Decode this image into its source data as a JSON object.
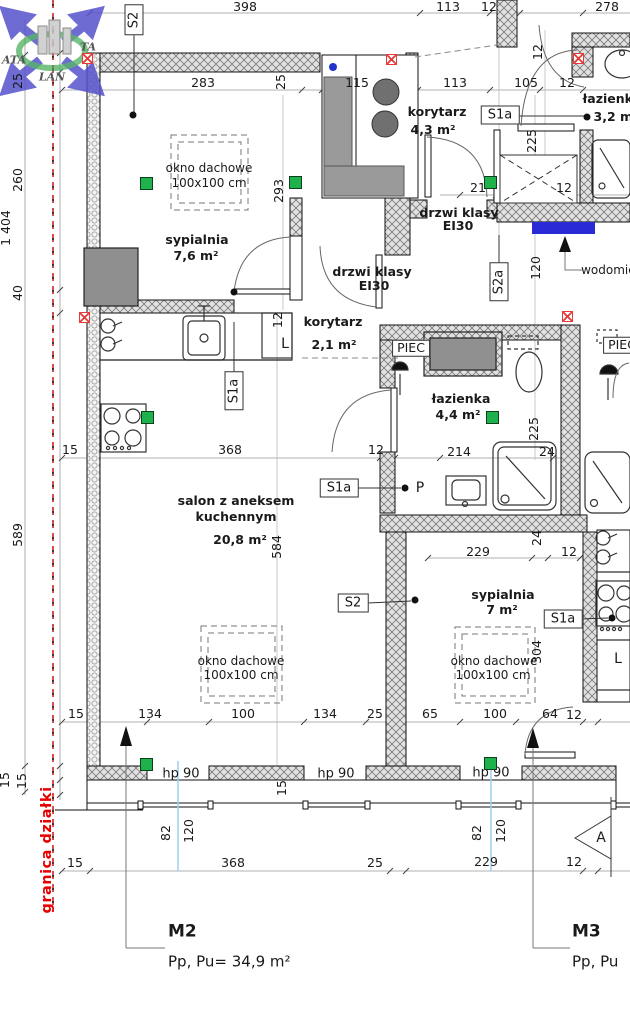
{
  "document": {
    "type": "architectural floor plan",
    "apartments": [
      {
        "name": "M2",
        "area_label": "Pp, Pu= 34,9 m²"
      },
      {
        "name": "M3",
        "area_label": "Pp, Pu"
      }
    ],
    "boundary_label": "granica działki",
    "section_marker": "A",
    "watermark": [
      "ATA",
      "TA",
      "LAN"
    ]
  },
  "colors": {
    "vent_green": "#1fb14b",
    "marker_red": "#e63b3b",
    "meter_blue": "#2a2ad6",
    "boundary_red": "#e60000",
    "window_axis_cyan": "#9ad1ee",
    "wall_gray": "#e2e2e2"
  },
  "rooms": [
    {
      "name": "sypialnia",
      "area": "7,6 m²"
    },
    {
      "name": "korytarz",
      "area": "4,3 m²"
    },
    {
      "name": "łazienka",
      "area": "3,2 m²"
    },
    {
      "name": "korytarz",
      "area": "2,1 m²"
    },
    {
      "name": "łazienka",
      "area": "4,4 m²"
    },
    {
      "name": "salon z aneksem kuchennym",
      "area": "20,8 m²"
    },
    {
      "name": "sypialnia",
      "area": "7 m²"
    }
  ],
  "labels": [
    {
      "t": "398",
      "x": 245,
      "y": 7,
      "c": "dim",
      "n": "dim-label"
    },
    {
      "t": "113",
      "x": 448,
      "y": 7,
      "c": "dim",
      "n": "dim-label"
    },
    {
      "t": "12",
      "x": 489,
      "y": 7,
      "c": "dim",
      "n": "dim-label"
    },
    {
      "t": "278",
      "x": 607,
      "y": 7,
      "c": "dim",
      "n": "dim-label"
    },
    {
      "t": "283",
      "x": 203,
      "y": 83,
      "c": "dim",
      "n": "dim-label"
    },
    {
      "t": "25",
      "x": 281,
      "y": 82,
      "c": "dim",
      "r": 1,
      "n": "dim-label"
    },
    {
      "t": "115",
      "x": 357,
      "y": 83,
      "c": "dim",
      "n": "dim-label"
    },
    {
      "t": "113",
      "x": 455,
      "y": 83,
      "c": "dim",
      "n": "dim-label"
    },
    {
      "t": "105",
      "x": 526,
      "y": 83,
      "c": "dim",
      "n": "dim-label"
    },
    {
      "t": "12",
      "x": 567,
      "y": 83,
      "c": "dim",
      "n": "dim-label"
    },
    {
      "t": "12",
      "x": 538,
      "y": 52,
      "c": "dim",
      "r": 1,
      "n": "dim-label"
    },
    {
      "t": "1 404",
      "x": 6,
      "y": 228,
      "c": "dim",
      "r": 1,
      "n": "dim-label"
    },
    {
      "t": "25",
      "x": 18,
      "y": 81,
      "c": "dim",
      "r": 1,
      "n": "dim-label"
    },
    {
      "t": "260",
      "x": 18,
      "y": 180,
      "c": "dim",
      "r": 1,
      "n": "dim-label"
    },
    {
      "t": "40",
      "x": 18,
      "y": 293,
      "c": "dim",
      "r": 1,
      "n": "dim-label"
    },
    {
      "t": "589",
      "x": 18,
      "y": 535,
      "c": "dim",
      "r": 1,
      "n": "dim-label"
    },
    {
      "t": "15",
      "x": 5,
      "y": 780,
      "c": "dim",
      "r": 1,
      "n": "dim-label"
    },
    {
      "t": "15",
      "x": 22,
      "y": 781,
      "c": "dim",
      "r": 1,
      "n": "dim-label"
    },
    {
      "t": "293",
      "x": 279,
      "y": 191,
      "c": "dim",
      "r": 1,
      "n": "dim-label"
    },
    {
      "t": "12",
      "x": 278,
      "y": 320,
      "c": "dim",
      "r": 1,
      "n": "dim-label"
    },
    {
      "t": "584",
      "x": 277,
      "y": 547,
      "c": "dim",
      "r": 1,
      "n": "dim-label"
    },
    {
      "t": "21",
      "x": 478,
      "y": 188,
      "c": "dim",
      "n": "dim-label"
    },
    {
      "t": "12",
      "x": 564,
      "y": 188,
      "c": "dim",
      "n": "dim-label"
    },
    {
      "t": "225",
      "x": 532,
      "y": 141,
      "c": "dim",
      "r": 1,
      "n": "dim-label"
    },
    {
      "t": "120",
      "x": 536,
      "y": 268,
      "c": "dim",
      "r": 1,
      "n": "dim-label"
    },
    {
      "t": "225",
      "x": 534,
      "y": 429,
      "c": "dim",
      "r": 1,
      "n": "dim-label"
    },
    {
      "t": "15",
      "x": 70,
      "y": 450,
      "c": "dim",
      "n": "dim-label"
    },
    {
      "t": "368",
      "x": 230,
      "y": 450,
      "c": "dim",
      "n": "dim-label"
    },
    {
      "t": "12",
      "x": 376,
      "y": 450,
      "c": "dim",
      "n": "dim-label"
    },
    {
      "t": "214",
      "x": 459,
      "y": 452,
      "c": "dim",
      "n": "dim-label"
    },
    {
      "t": "24",
      "x": 547,
      "y": 452,
      "c": "dim",
      "n": "dim-label"
    },
    {
      "t": "24",
      "x": 537,
      "y": 538,
      "c": "dim",
      "r": 1,
      "n": "dim-label"
    },
    {
      "t": "229",
      "x": 478,
      "y": 552,
      "c": "dim",
      "n": "dim-label"
    },
    {
      "t": "12",
      "x": 569,
      "y": 552,
      "c": "dim",
      "n": "dim-label"
    },
    {
      "t": "304",
      "x": 537,
      "y": 652,
      "c": "dim",
      "r": 1,
      "n": "dim-label"
    },
    {
      "t": "15",
      "x": 76,
      "y": 714,
      "c": "dim",
      "n": "dim-label"
    },
    {
      "t": "134",
      "x": 150,
      "y": 714,
      "c": "dim",
      "n": "dim-label"
    },
    {
      "t": "100",
      "x": 243,
      "y": 714,
      "c": "dim",
      "n": "dim-label"
    },
    {
      "t": "134",
      "x": 325,
      "y": 714,
      "c": "dim",
      "n": "dim-label"
    },
    {
      "t": "25",
      "x": 375,
      "y": 714,
      "c": "dim",
      "n": "dim-label"
    },
    {
      "t": "65",
      "x": 430,
      "y": 714,
      "c": "dim",
      "n": "dim-label"
    },
    {
      "t": "100",
      "x": 495,
      "y": 714,
      "c": "dim",
      "n": "dim-label"
    },
    {
      "t": "64",
      "x": 550,
      "y": 714,
      "c": "dim",
      "n": "dim-label"
    },
    {
      "t": "12",
      "x": 574,
      "y": 715,
      "c": "dim",
      "n": "dim-label"
    },
    {
      "t": "15",
      "x": 282,
      "y": 788,
      "c": "dim",
      "r": 1,
      "n": "dim-label"
    },
    {
      "t": "82",
      "x": 166,
      "y": 833,
      "c": "dim",
      "r": 1,
      "n": "dim-label"
    },
    {
      "t": "120",
      "x": 189,
      "y": 831,
      "c": "dim",
      "r": 1,
      "n": "dim-label"
    },
    {
      "t": "82",
      "x": 477,
      "y": 833,
      "c": "dim",
      "r": 1,
      "n": "dim-label"
    },
    {
      "t": "120",
      "x": 501,
      "y": 831,
      "c": "dim",
      "r": 1,
      "n": "dim-label"
    },
    {
      "t": "15",
      "x": 75,
      "y": 863,
      "c": "dim",
      "n": "dim-label"
    },
    {
      "t": "368",
      "x": 233,
      "y": 863,
      "c": "dim",
      "n": "dim-label"
    },
    {
      "t": "25",
      "x": 375,
      "y": 863,
      "c": "dim",
      "n": "dim-label"
    },
    {
      "t": "229",
      "x": 486,
      "y": 862,
      "c": "dim",
      "n": "dim-label"
    },
    {
      "t": "12",
      "x": 574,
      "y": 862,
      "c": "dim",
      "n": "dim-label"
    },
    {
      "t": "sypialnia",
      "x": 197,
      "y": 240,
      "c": "room",
      "n": "room-name-sypialnia-76"
    },
    {
      "t": "7,6 m²",
      "x": 196,
      "y": 256,
      "c": "room",
      "n": "room-area-sypialnia-76"
    },
    {
      "t": "korytarz",
      "x": 437,
      "y": 112,
      "c": "room",
      "n": "room-name-korytarz-43"
    },
    {
      "t": "4,3 m²",
      "x": 433,
      "y": 130,
      "c": "room",
      "n": "room-area-korytarz-43"
    },
    {
      "t": "łazienka",
      "x": 612,
      "y": 99,
      "c": "room",
      "n": "room-name-lazienka-32"
    },
    {
      "t": "3,2 m²",
      "x": 616,
      "y": 117,
      "c": "room",
      "n": "room-area-lazienka-32"
    },
    {
      "t": "drzwi klasy",
      "x": 459,
      "y": 213,
      "c": "room",
      "n": "door-class-label"
    },
    {
      "t": "EI30",
      "x": 458,
      "y": 226,
      "c": "room",
      "n": "door-class-label"
    },
    {
      "t": "drzwi klasy",
      "x": 372,
      "y": 272,
      "c": "room",
      "n": "door-class-label"
    },
    {
      "t": "EI30",
      "x": 374,
      "y": 286,
      "c": "room",
      "n": "door-class-label"
    },
    {
      "t": "korytarz",
      "x": 333,
      "y": 322,
      "c": "room",
      "n": "room-name-korytarz-21"
    },
    {
      "t": "2,1 m²",
      "x": 334,
      "y": 345,
      "c": "room",
      "n": "room-area-korytarz-21"
    },
    {
      "t": "łazienka",
      "x": 461,
      "y": 399,
      "c": "room",
      "n": "room-name-lazienka-44"
    },
    {
      "t": "4,4 m²",
      "x": 458,
      "y": 415,
      "c": "room",
      "n": "room-area-lazienka-44"
    },
    {
      "t": "salon z aneksem",
      "x": 236,
      "y": 501,
      "c": "room",
      "n": "room-name-salon"
    },
    {
      "t": "kuchennym",
      "x": 236,
      "y": 517,
      "c": "room",
      "n": "room-name-salon"
    },
    {
      "t": "20,8 m²",
      "x": 240,
      "y": 540,
      "c": "room",
      "n": "room-area-salon"
    },
    {
      "t": "sypialnia",
      "x": 503,
      "y": 595,
      "c": "room",
      "n": "room-name-sypialnia-7"
    },
    {
      "t": "7 m²",
      "x": 502,
      "y": 610,
      "c": "room",
      "n": "room-area-sypialnia-7"
    },
    {
      "t": "okno dachowe",
      "x": 209,
      "y": 168,
      "c": "sub",
      "n": "skylight-label"
    },
    {
      "t": "100x100 cm",
      "x": 209,
      "y": 183,
      "c": "sub",
      "n": "skylight-size"
    },
    {
      "t": "okno dachowe",
      "x": 241,
      "y": 661,
      "c": "sub",
      "n": "skylight-label"
    },
    {
      "t": "100x100 cm",
      "x": 241,
      "y": 675,
      "c": "sub",
      "n": "skylight-size"
    },
    {
      "t": "okno dachowe",
      "x": 494,
      "y": 661,
      "c": "sub",
      "n": "skylight-label"
    },
    {
      "t": "100x100 cm",
      "x": 493,
      "y": 675,
      "c": "sub",
      "n": "skylight-size"
    },
    {
      "t": "PIEC",
      "x": 411,
      "y": 348,
      "c": "pbox",
      "n": "furnace-label"
    },
    {
      "t": "PIEC",
      "x": 622,
      "y": 345,
      "c": "pbox",
      "n": "furnace-label"
    },
    {
      "t": "wodomierz",
      "x": 614,
      "y": 270,
      "c": "sub",
      "n": "water-meter-label"
    },
    {
      "t": "P",
      "x": 420,
      "y": 488,
      "c": "plabel",
      "n": "p-point-label"
    },
    {
      "t": "L",
      "x": 285,
      "y": 344,
      "c": "plabel",
      "n": "fridge-label"
    },
    {
      "t": "L",
      "x": 618,
      "y": 659,
      "c": "plabel",
      "n": "fridge-label"
    },
    {
      "t": "hp 90",
      "x": 181,
      "y": 774,
      "c": "hp",
      "n": "parapet-height-label"
    },
    {
      "t": "hp 90",
      "x": 336,
      "y": 774,
      "c": "hp",
      "n": "parapet-height-label"
    },
    {
      "t": "hp 90",
      "x": 491,
      "y": 773,
      "c": "hp",
      "n": "parapet-height-label"
    },
    {
      "t": "A",
      "x": 601,
      "y": 838,
      "c": "plabel",
      "n": "section-marker-label"
    },
    {
      "t": "S2",
      "x": 134,
      "y": 20,
      "c": "sbox",
      "r": 1,
      "n": "s2-tag"
    },
    {
      "t": "S1a",
      "x": 500,
      "y": 115,
      "c": "sbox",
      "n": "s1a-tag"
    },
    {
      "t": "S2a",
      "x": 499,
      "y": 282,
      "c": "sbox",
      "r": 1,
      "n": "s2a-tag"
    },
    {
      "t": "S1a",
      "x": 234,
      "y": 391,
      "c": "sbox",
      "r": 1,
      "n": "s1a-tag"
    },
    {
      "t": "S1a",
      "x": 339,
      "y": 488,
      "c": "sbox",
      "n": "s1a-tag"
    },
    {
      "t": "S2",
      "x": 353,
      "y": 603,
      "c": "sbox",
      "n": "s2-tag"
    },
    {
      "t": "S1a",
      "x": 563,
      "y": 619,
      "c": "sbox",
      "n": "s1a-tag"
    },
    {
      "t": "M2",
      "x": 168,
      "y": 932,
      "c": "title",
      "n": "apartment-m2-title"
    },
    {
      "t": "Pp, Pu= 34,9 m²",
      "x": 168,
      "y": 962,
      "c": "subtitle",
      "n": "apartment-m2-area"
    },
    {
      "t": "M3",
      "x": 572,
      "y": 932,
      "c": "title",
      "n": "apartment-m3-title"
    },
    {
      "t": "Pp, Pu",
      "x": 572,
      "y": 962,
      "c": "subtitle",
      "n": "apartment-m3-area"
    },
    {
      "t": "granica działki",
      "x": 47,
      "y": 850,
      "c": "boundary",
      "r": 1,
      "n": "plot-boundary-label"
    },
    {
      "t": "ATA",
      "x": 14,
      "y": 60,
      "c": "wm",
      "n": "watermark-text"
    },
    {
      "t": "TA",
      "x": 88,
      "y": 47,
      "c": "wm",
      "n": "watermark-text"
    },
    {
      "t": "LAN",
      "x": 52,
      "y": 77,
      "c": "wm",
      "n": "watermark-text"
    }
  ],
  "markers": {
    "green_squares": [
      [
        140,
        177
      ],
      [
        289,
        176
      ],
      [
        484,
        176
      ],
      [
        141,
        411
      ],
      [
        486,
        411
      ],
      [
        140,
        758
      ],
      [
        484,
        757
      ]
    ],
    "red_crosses": [
      [
        82,
        53
      ],
      [
        386,
        54
      ],
      [
        573,
        53
      ],
      [
        79,
        312
      ],
      [
        562,
        311
      ]
    ],
    "black_dots": [
      [
        133,
        115
      ],
      [
        587,
        117
      ],
      [
        405,
        488
      ],
      [
        415,
        600
      ],
      [
        234,
        292
      ],
      [
        612,
        618
      ]
    ],
    "blue_dot": [
      333,
      67
    ],
    "water_meter_rect": [
      532,
      222,
      63,
      12
    ]
  }
}
